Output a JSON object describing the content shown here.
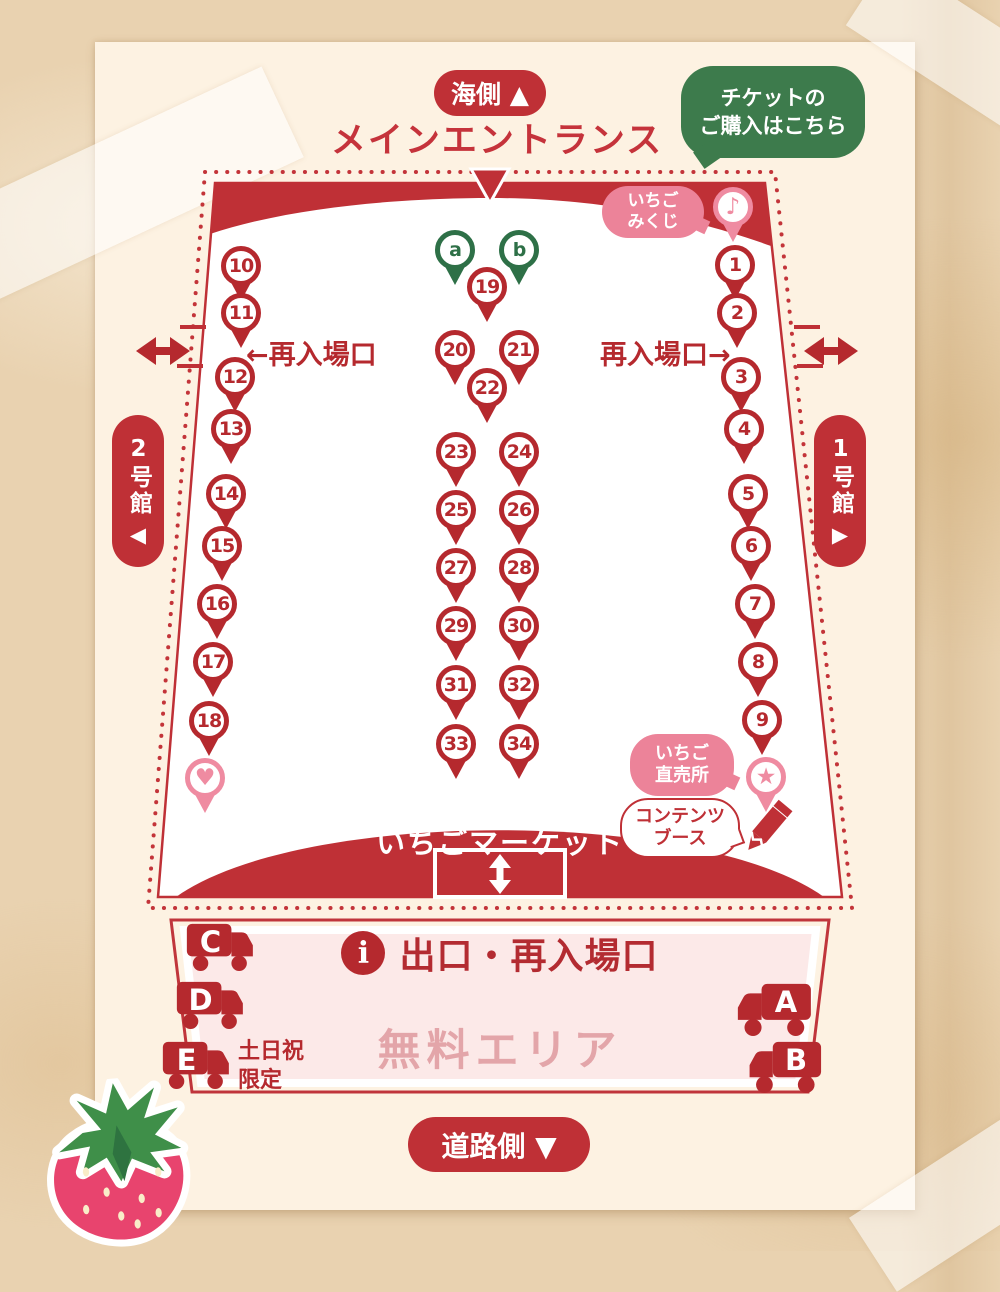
{
  "colors": {
    "red": "#bf3036",
    "dark_red": "#b5292e",
    "pink": "#ef8ba1",
    "bubble_pink": "#ec8399",
    "green_bubble": "#3d7b4c",
    "green_pin": "#2e7047",
    "poster_cream": "#fdf2e2",
    "paper": "#e9d2b0",
    "free_area_fill": "#fce9e8",
    "free_area_text": "#e3a5a9"
  },
  "top": {
    "sea_side_label": "海側 ▲",
    "main_entrance_title": "メインエントランス",
    "ticket_bubble_lines": [
      "チケットの",
      "ご購入はこちら"
    ]
  },
  "map": {
    "mikuji_bubble_lines": [
      "いちご",
      "みくじ"
    ],
    "reentry_left_label": "←再入場口",
    "reentry_right_label": "再入場口→",
    "building_left_label": "2号館",
    "building_left_arrow": "◀",
    "building_right_label": "1号館",
    "building_right_arrow": "▶",
    "chokubai_bubble_lines": [
      "いちご",
      "直売所"
    ],
    "contents_bubble_lines": [
      "コンテンツ",
      "ブース"
    ],
    "market_label": "いちごマーケット",
    "pins": [
      {
        "label": "a",
        "x": 455,
        "y": 250,
        "color": "green"
      },
      {
        "label": "b",
        "x": 519,
        "y": 250,
        "color": "green"
      },
      {
        "label": "19",
        "x": 487,
        "y": 287,
        "color": "red"
      },
      {
        "label": "20",
        "x": 455,
        "y": 350,
        "color": "red"
      },
      {
        "label": "21",
        "x": 519,
        "y": 350,
        "color": "red"
      },
      {
        "label": "22",
        "x": 487,
        "y": 388,
        "color": "red"
      },
      {
        "label": "23",
        "x": 456,
        "y": 452,
        "color": "red"
      },
      {
        "label": "24",
        "x": 519,
        "y": 452,
        "color": "red"
      },
      {
        "label": "25",
        "x": 456,
        "y": 510,
        "color": "red"
      },
      {
        "label": "26",
        "x": 519,
        "y": 510,
        "color": "red"
      },
      {
        "label": "27",
        "x": 456,
        "y": 568,
        "color": "red"
      },
      {
        "label": "28",
        "x": 519,
        "y": 568,
        "color": "red"
      },
      {
        "label": "29",
        "x": 456,
        "y": 626,
        "color": "red"
      },
      {
        "label": "30",
        "x": 519,
        "y": 626,
        "color": "red"
      },
      {
        "label": "31",
        "x": 456,
        "y": 685,
        "color": "red"
      },
      {
        "label": "32",
        "x": 519,
        "y": 685,
        "color": "red"
      },
      {
        "label": "33",
        "x": 456,
        "y": 744,
        "color": "red"
      },
      {
        "label": "34",
        "x": 519,
        "y": 744,
        "color": "red"
      },
      {
        "label": "10",
        "x": 241,
        "y": 266,
        "color": "red"
      },
      {
        "label": "11",
        "x": 241,
        "y": 313,
        "color": "red"
      },
      {
        "label": "12",
        "x": 235,
        "y": 377,
        "color": "red"
      },
      {
        "label": "13",
        "x": 231,
        "y": 429,
        "color": "red"
      },
      {
        "label": "14",
        "x": 226,
        "y": 494,
        "color": "red"
      },
      {
        "label": "15",
        "x": 222,
        "y": 546,
        "color": "red"
      },
      {
        "label": "16",
        "x": 217,
        "y": 604,
        "color": "red"
      },
      {
        "label": "17",
        "x": 213,
        "y": 662,
        "color": "red"
      },
      {
        "label": "18",
        "x": 209,
        "y": 721,
        "color": "red"
      },
      {
        "icon": "heart",
        "glyph": "♥",
        "x": 205,
        "y": 778,
        "color": "pink"
      },
      {
        "label": "1",
        "x": 735,
        "y": 265,
        "color": "red"
      },
      {
        "label": "2",
        "x": 737,
        "y": 313,
        "color": "red"
      },
      {
        "label": "3",
        "x": 741,
        "y": 377,
        "color": "red"
      },
      {
        "label": "4",
        "x": 744,
        "y": 429,
        "color": "red"
      },
      {
        "label": "5",
        "x": 748,
        "y": 494,
        "color": "red"
      },
      {
        "label": "6",
        "x": 751,
        "y": 546,
        "color": "red"
      },
      {
        "label": "7",
        "x": 755,
        "y": 604,
        "color": "red"
      },
      {
        "label": "8",
        "x": 758,
        "y": 662,
        "color": "red"
      },
      {
        "label": "9",
        "x": 762,
        "y": 720,
        "color": "red"
      },
      {
        "icon": "star",
        "glyph": "★",
        "x": 766,
        "y": 777,
        "color": "pink"
      },
      {
        "icon": "music",
        "glyph": "♪",
        "x": 733,
        "y": 207,
        "color": "pink"
      }
    ]
  },
  "free_area": {
    "info_glyph": "i",
    "exit_label": "出口・再入場口",
    "area_label": "無料エリア",
    "weekend_lines": [
      "土日祝",
      "限定"
    ],
    "trucks": [
      {
        "label": "C",
        "x": 186,
        "y": 922,
        "w": 72,
        "facing": "right"
      },
      {
        "label": "D",
        "x": 176,
        "y": 980,
        "w": 72,
        "facing": "right"
      },
      {
        "label": "E",
        "x": 162,
        "y": 1040,
        "w": 72,
        "facing": "right"
      },
      {
        "label": "A",
        "x": 732,
        "y": 982,
        "w": 80,
        "facing": "left"
      },
      {
        "label": "B",
        "x": 744,
        "y": 1040,
        "w": 78,
        "facing": "left"
      }
    ]
  },
  "bottom": {
    "road_side_label": "道路側 ▼"
  }
}
